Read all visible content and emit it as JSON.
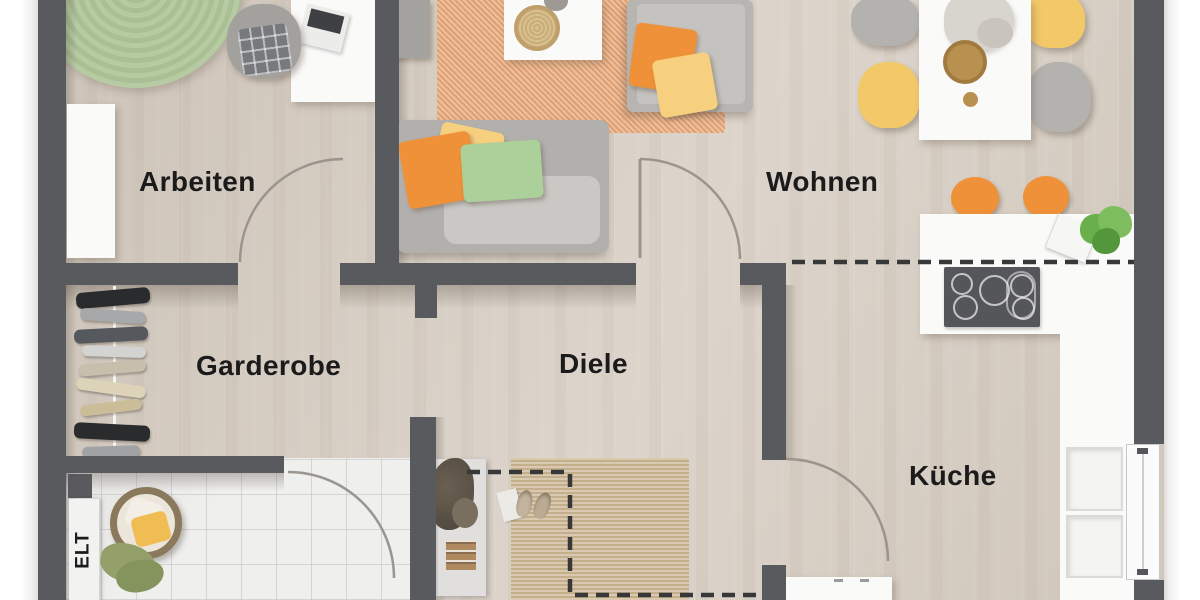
{
  "rooms": {
    "arbeiten": {
      "label": "Arbeiten",
      "furniture": [
        "round-rug",
        "desk",
        "desk-chair",
        "laptop",
        "wardrobe-shelf"
      ]
    },
    "wohnen": {
      "label": "Wohnen",
      "furniture": [
        "sofa",
        "armchair",
        "coffee-table",
        "area-rug",
        "console-table",
        "dining-table",
        "dining-chairs",
        "centerpiece-flowers",
        "decor-bowl"
      ]
    },
    "garderobe": {
      "label": "Garderobe",
      "furniture": [
        "coat-rack"
      ]
    },
    "diele": {
      "label": "Diele",
      "furniture": [
        "jute-rug",
        "sideboard",
        "dried-plant",
        "slippers",
        "magazine"
      ]
    },
    "kueche": {
      "label": "Küche",
      "furniture": [
        "bar-counter",
        "bar-stools",
        "cooktop",
        "counter-plant",
        "sink-niches",
        "base-cabinet",
        "window"
      ]
    },
    "elt": {
      "label": "ELT"
    },
    "bathroom": {
      "furniture": [
        "laundry-basket",
        "towels",
        "elt-panel"
      ]
    }
  },
  "colors": {
    "wall": "#595a5d",
    "floor-wood": "#d7cec3",
    "floor-tile": "#efefee",
    "rug-green": "#b4c8a0",
    "rug-orange": "#e7a87a",
    "rug-jute": "#ccb795",
    "accent-orange": "#ef9138",
    "accent-yellow": "#f3c869",
    "accent-green": "#abd09a",
    "furniture-gray": "#b4b2af",
    "furniture-white": "#fafaf9",
    "cooktop": "#55565a",
    "door-arc": "#9a958d",
    "dashed": "#383838",
    "label": "#1b1b1b",
    "outside": "#ffffff"
  }
}
